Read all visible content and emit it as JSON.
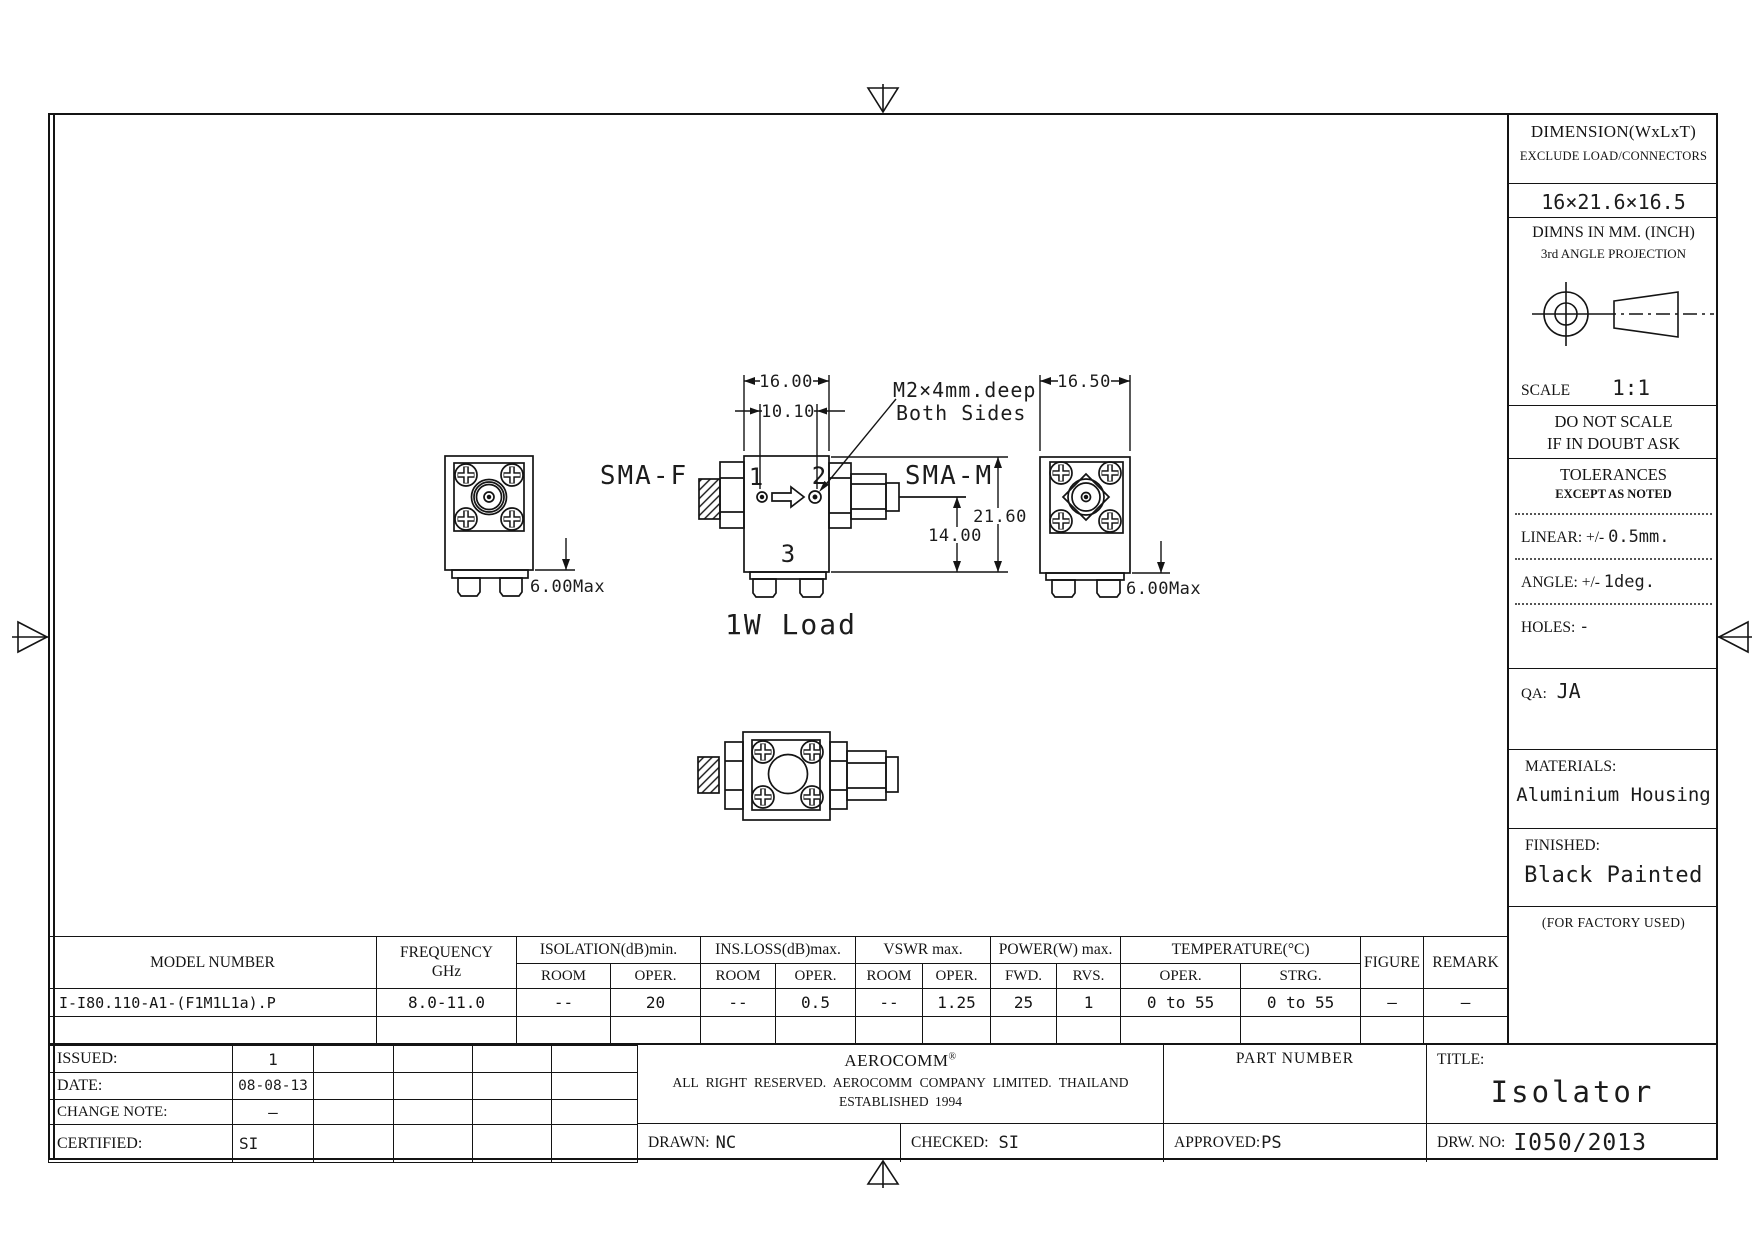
{
  "sidebar": {
    "dimension_title": "DIMENSION(WxLxT)",
    "dimension_subtitle": "EXCLUDE LOAD/CONNECTORS",
    "dimension_value": "16×21.6×16.5",
    "units_line1": "DIMNS IN MM. (INCH)",
    "units_line2": "3rd ANGLE PROJECTION",
    "scale_label": "SCALE",
    "scale_value": "1:1",
    "warning_line1": "DO NOT SCALE",
    "warning_line2": "IF IN DOUBT ASK",
    "tolerances_title": "TOLERANCES",
    "tolerances_subtitle": "EXCEPT AS NOTED",
    "linear_label": "LINEAR: +/-",
    "linear_value": "0.5mm.",
    "angle_label": "ANGLE: +/-",
    "angle_value": "1deg.",
    "holes_label": "HOLES:",
    "holes_value": "-",
    "qa_label": "QA:",
    "qa_value": "JA",
    "materials_label": "MATERIALS:",
    "materials_value": "Aluminium Housing",
    "finished_label": "FINISHED:",
    "finished_value": "Black Painted",
    "factory_note": "(FOR FACTORY USED)"
  },
  "drawing": {
    "labels": {
      "sma_f": "SMA-F",
      "sma_m": "SMA-M",
      "port_1": "1",
      "port_2": "2",
      "port_3": "3",
      "load": "1W Load",
      "note_line1": "M2×4mm.deep",
      "note_line2": "Both Sides"
    },
    "dims": {
      "body_width": "16.00",
      "hole_spacing": "10.10",
      "total_height": "21.60",
      "axis_height": "14.00",
      "side_width": "16.50",
      "feet_left": "6.00Max",
      "feet_right": "6.00Max"
    }
  },
  "spec_table": {
    "headers": {
      "model": "MODEL NUMBER",
      "frequency_line1": "FREQUENCY",
      "frequency_line2": "GHz",
      "isolation": "ISOLATION(dB)min.",
      "ins_loss": "INS.LOSS(dB)max.",
      "vswr": "VSWR max.",
      "power": "POWER(W) max.",
      "temperature": "TEMPERATURE(°C)",
      "room": "ROOM",
      "oper": "OPER.",
      "fwd": "FWD.",
      "rvs": "RVS.",
      "strg": "STRG.",
      "figure": "FIGURE",
      "remark": "REMARK"
    },
    "row": {
      "model": "I-I80.110-A1-(F1M1L1a).P",
      "frequency": "8.0-11.0",
      "isolation_room": "--",
      "isolation_oper": "20",
      "ins_loss_room": "--",
      "ins_loss_oper": "0.5",
      "vswr_room": "--",
      "vswr_oper": "1.25",
      "power_fwd": "25",
      "power_rvs": "1",
      "temp_oper": "0 to 55",
      "temp_strg": "0 to 55",
      "figure": "—",
      "remark": "—"
    }
  },
  "title_block": {
    "issued_label": "ISSUED:",
    "issued_value": "1",
    "date_label": "DATE:",
    "date_value": "08-08-13",
    "change_note_label": "CHANGE NOTE:",
    "change_note_value": "—",
    "certified_label": "CERTIFIED:",
    "certified_value": "SI",
    "company_name": "AEROCOMM",
    "registered_mark": "®",
    "company_line2": "ALL RIGHT RESERVED. AEROCOMM COMPANY LIMITED. THAILAND",
    "company_line3": "ESTABLISHED 1994",
    "drawn_label": "DRAWN:",
    "drawn_value": "NC",
    "checked_label": "CHECKED:",
    "checked_value": "SI",
    "approved_label": "APPROVED:",
    "approved_value": "PS",
    "part_number_label": "PART NUMBER",
    "title_label": "TITLE:",
    "title_value": "Isolator",
    "drw_no_label": "DRW. NO:",
    "drw_no_value": "I050/2013"
  }
}
